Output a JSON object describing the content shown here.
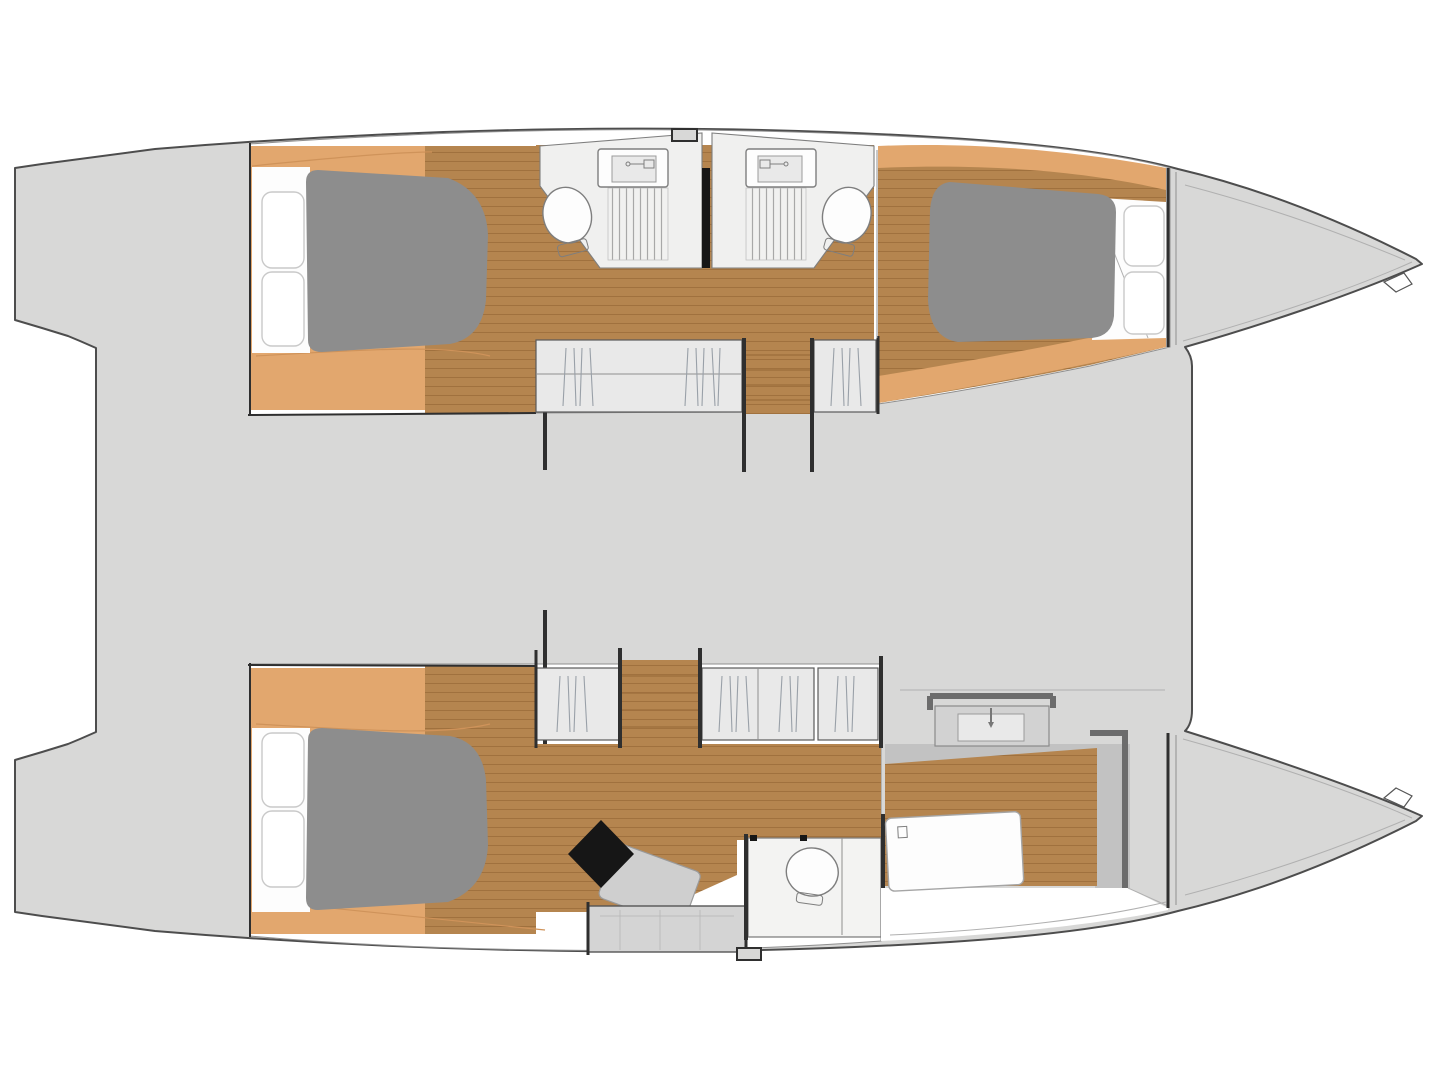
{
  "figure": {
    "type": "boat-floor-plan",
    "description": "Top-view deck plan of a sailing catamaran, bows pointing right, with two hulls joined by a grey bridge deck",
    "orientation": "bows-right"
  },
  "colors": {
    "outline": "#4d4d4d",
    "outline-light": "#8f8f8f",
    "deck": "#d8d8d7",
    "hull-white": "#ffffff",
    "wood-dark": "#b5854f",
    "wood-line": "#a0713e",
    "wood-light": "#e2a76e",
    "wood-light-line": "#cf935a",
    "mattress": "#8d8d8d",
    "pillow-stroke": "#c9c9c9",
    "bath-floor": "#f0f0ef",
    "fixture-stroke": "#7e7e7e",
    "grate": "#a8a8a8",
    "wall-dark": "#2f2f2f",
    "wall-owner": "#6c6c6c",
    "owner-band": "#c2c2c2",
    "furn-gray": "#cfcfcf",
    "wardrobe": "#e9e9e9",
    "hatch-line": "#99a0a8",
    "black": "#161616",
    "page-bg": "#ffffff",
    "seam": "#b0b0b0"
  },
  "areas": {
    "bridge_deck": "bridge deck between hulls",
    "port_hull": "upper (port) guest hull with two double cabins and two shower rooms",
    "port_aft_cabin": "aft double cabin with island berth and pillows",
    "port_aft_bathroom": "aft shower room with basin, toilet and shower grating",
    "port_fwd_bathroom": "forward shower room with basin, toilet and shower grating",
    "port_fwd_cabin": "forward double cabin with island berth and pillows",
    "port_wardrobes": "hanging lockers along the companionway",
    "starboard_hull": "lower (starboard) owner hull with suite, desk, toilet room and dressing",
    "stb_aft_cabin": "owner berth aft with pillows",
    "stb_desk": "desk with seat in owner suite",
    "stb_toilet_room": "separate toilet compartment",
    "stb_dressing": "forward dressing / bathroom with basin counter",
    "bows": "moulded bows with anchor fitting",
    "sterns": "transom steps / aft platforms"
  },
  "fixtures": {
    "toilets": 3,
    "basins": 3,
    "berths": 3,
    "shower_gratings": 2,
    "deck_hatches": 2
  }
}
